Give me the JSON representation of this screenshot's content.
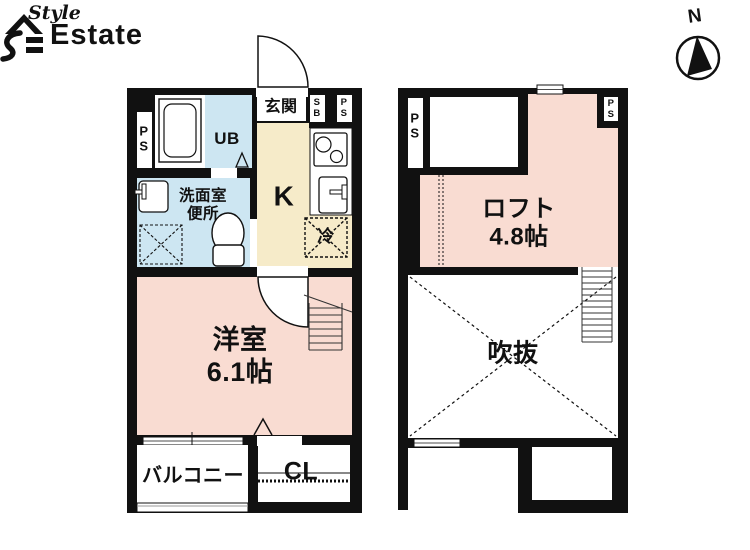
{
  "brand": {
    "style": "Style",
    "estate": "Estate"
  },
  "compass": {
    "north_label": "N"
  },
  "colors": {
    "wall": "#111111",
    "room_pink": "#f9dcd2",
    "room_blue": "#cde6f2",
    "room_cream": "#f6ebc9",
    "background": "#ffffff"
  },
  "floor1": {
    "labels": {
      "ps_left": "P\nS",
      "unit_bath": "UB",
      "entrance": "玄関",
      "shoe_box": "S\nB",
      "ps_right": "P\nS",
      "kitchen": "K",
      "washroom_toilet": "洗面室\n便所",
      "fridge": "冷",
      "western_room": "洋室\n6.1帖",
      "balcony": "バルコニー",
      "closet": "CL"
    }
  },
  "floor2": {
    "labels": {
      "ps_left": "P\nS",
      "ps_right": "P\nS",
      "loft": "ロフト\n4.8帖",
      "void": "吹抜"
    }
  }
}
